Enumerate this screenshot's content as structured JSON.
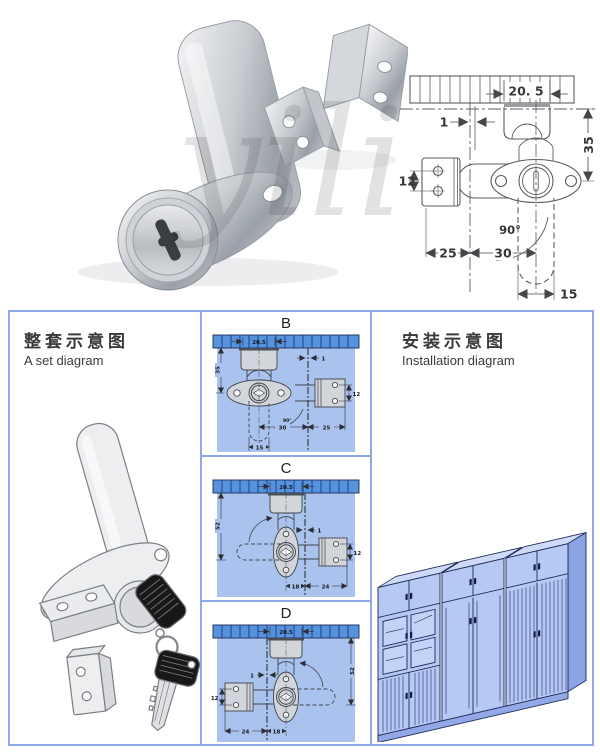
{
  "photo": {
    "watermark": "yili"
  },
  "top_drawing": {
    "dim_panel_width": "20. 5",
    "dim_gap": "1",
    "dim_height": "35",
    "dim_bracket_holes": "12",
    "dim_offset_left": "25",
    "dim_offset_right": "30",
    "dim_tongue": "15",
    "dim_angle": "90°"
  },
  "set_panel": {
    "title_cn": "整套示意图",
    "title_en": "A set diagram"
  },
  "variants": {
    "b": {
      "label": "B",
      "dim_panel_width": "20.5",
      "dim_gap": "1",
      "dim_height": "35",
      "dim_bracket_holes": "12",
      "dim_inner": "30",
      "dim_outer": "25",
      "dim_tongue": "15",
      "dim_angle": "90°"
    },
    "c": {
      "label": "C",
      "dim_panel_width": "20.5",
      "dim_gap": "1",
      "dim_height": "52",
      "dim_bracket_holes": "12",
      "dim_inner": "18",
      "dim_outer": "24"
    },
    "d": {
      "label": "D",
      "dim_panel_width": "20.5",
      "dim_gap": "1",
      "dim_height": "52",
      "dim_bracket_holes": "12",
      "dim_inner": "18",
      "dim_outer": "24"
    }
  },
  "install_panel": {
    "title_cn": "安装示意图",
    "title_en": "Installation diagram"
  },
  "colors": {
    "panel_border": "#8ea8ee",
    "diagram_bg": "#a9c2ee",
    "hatch_bar": "#5693dc",
    "line_gray": "#55585e",
    "cabinet_fill": "#b6c8f4"
  }
}
